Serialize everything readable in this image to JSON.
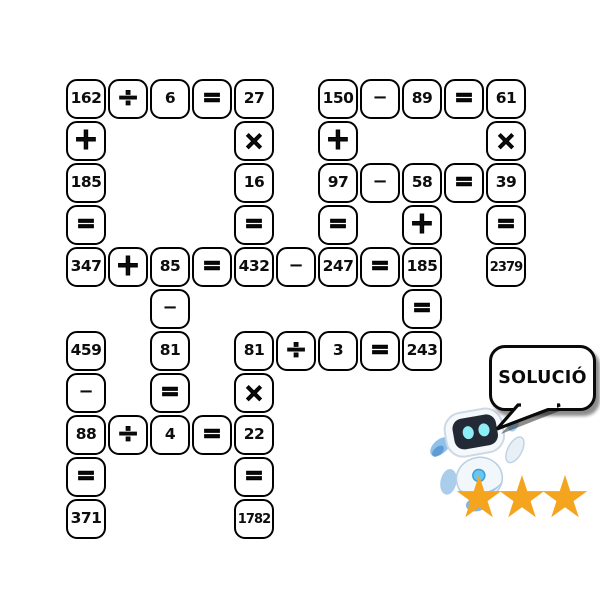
{
  "puzzle": {
    "grid": {
      "columns": 11,
      "rows": 11,
      "cell_size": 40,
      "gap": 2
    },
    "cells": [
      {
        "col": 1,
        "row": 1,
        "text": "162",
        "kind": "number"
      },
      {
        "col": 2,
        "row": 1,
        "text": "÷",
        "kind": "op-div"
      },
      {
        "col": 3,
        "row": 1,
        "text": "6",
        "kind": "number"
      },
      {
        "col": 4,
        "row": 1,
        "text": "=",
        "kind": "op-eq"
      },
      {
        "col": 5,
        "row": 1,
        "text": "27",
        "kind": "number"
      },
      {
        "col": 7,
        "row": 1,
        "text": "150",
        "kind": "number"
      },
      {
        "col": 8,
        "row": 1,
        "text": "−",
        "kind": "op-minus"
      },
      {
        "col": 9,
        "row": 1,
        "text": "89",
        "kind": "number"
      },
      {
        "col": 10,
        "row": 1,
        "text": "=",
        "kind": "op-eq"
      },
      {
        "col": 11,
        "row": 1,
        "text": "61",
        "kind": "number"
      },
      {
        "col": 1,
        "row": 2,
        "text": "+",
        "kind": "op-plus"
      },
      {
        "col": 5,
        "row": 2,
        "text": "×",
        "kind": "op-times"
      },
      {
        "col": 7,
        "row": 2,
        "text": "+",
        "kind": "op-plus"
      },
      {
        "col": 11,
        "row": 2,
        "text": "×",
        "kind": "op-times"
      },
      {
        "col": 1,
        "row": 3,
        "text": "185",
        "kind": "number"
      },
      {
        "col": 5,
        "row": 3,
        "text": "16",
        "kind": "number"
      },
      {
        "col": 7,
        "row": 3,
        "text": "97",
        "kind": "number"
      },
      {
        "col": 8,
        "row": 3,
        "text": "−",
        "kind": "op-minus"
      },
      {
        "col": 9,
        "row": 3,
        "text": "58",
        "kind": "number"
      },
      {
        "col": 10,
        "row": 3,
        "text": "=",
        "kind": "op-eq"
      },
      {
        "col": 11,
        "row": 3,
        "text": "39",
        "kind": "number"
      },
      {
        "col": 1,
        "row": 4,
        "text": "=",
        "kind": "op-eq"
      },
      {
        "col": 5,
        "row": 4,
        "text": "=",
        "kind": "op-eq"
      },
      {
        "col": 7,
        "row": 4,
        "text": "=",
        "kind": "op-eq"
      },
      {
        "col": 9,
        "row": 4,
        "text": "+",
        "kind": "op-plus"
      },
      {
        "col": 11,
        "row": 4,
        "text": "=",
        "kind": "op-eq"
      },
      {
        "col": 1,
        "row": 5,
        "text": "347",
        "kind": "number"
      },
      {
        "col": 2,
        "row": 5,
        "text": "+",
        "kind": "op-plus"
      },
      {
        "col": 3,
        "row": 5,
        "text": "85",
        "kind": "number"
      },
      {
        "col": 4,
        "row": 5,
        "text": "=",
        "kind": "op-eq"
      },
      {
        "col": 5,
        "row": 5,
        "text": "432",
        "kind": "number"
      },
      {
        "col": 6,
        "row": 5,
        "text": "−",
        "kind": "op-minus"
      },
      {
        "col": 7,
        "row": 5,
        "text": "247",
        "kind": "number"
      },
      {
        "col": 8,
        "row": 5,
        "text": "=",
        "kind": "op-eq"
      },
      {
        "col": 9,
        "row": 5,
        "text": "185",
        "kind": "number"
      },
      {
        "col": 11,
        "row": 5,
        "text": "2379",
        "kind": "number"
      },
      {
        "col": 3,
        "row": 6,
        "text": "−",
        "kind": "op-minus"
      },
      {
        "col": 9,
        "row": 6,
        "text": "=",
        "kind": "op-eq"
      },
      {
        "col": 1,
        "row": 7,
        "text": "459",
        "kind": "number"
      },
      {
        "col": 3,
        "row": 7,
        "text": "81",
        "kind": "number"
      },
      {
        "col": 5,
        "row": 7,
        "text": "81",
        "kind": "number"
      },
      {
        "col": 6,
        "row": 7,
        "text": "÷",
        "kind": "op-div"
      },
      {
        "col": 7,
        "row": 7,
        "text": "3",
        "kind": "number"
      },
      {
        "col": 8,
        "row": 7,
        "text": "=",
        "kind": "op-eq"
      },
      {
        "col": 9,
        "row": 7,
        "text": "243",
        "kind": "number"
      },
      {
        "col": 1,
        "row": 8,
        "text": "−",
        "kind": "op-minus"
      },
      {
        "col": 3,
        "row": 8,
        "text": "=",
        "kind": "op-eq"
      },
      {
        "col": 5,
        "row": 8,
        "text": "×",
        "kind": "op-times"
      },
      {
        "col": 1,
        "row": 9,
        "text": "88",
        "kind": "number"
      },
      {
        "col": 2,
        "row": 9,
        "text": "÷",
        "kind": "op-div"
      },
      {
        "col": 3,
        "row": 9,
        "text": "4",
        "kind": "number"
      },
      {
        "col": 4,
        "row": 9,
        "text": "=",
        "kind": "op-eq"
      },
      {
        "col": 5,
        "row": 9,
        "text": "22",
        "kind": "number"
      },
      {
        "col": 1,
        "row": 10,
        "text": "=",
        "kind": "op-eq"
      },
      {
        "col": 5,
        "row": 10,
        "text": "=",
        "kind": "op-eq"
      },
      {
        "col": 1,
        "row": 11,
        "text": "371",
        "kind": "number"
      },
      {
        "col": 5,
        "row": 11,
        "text": "1782",
        "kind": "number"
      }
    ]
  },
  "speech_bubble": {
    "label": "SOLUCIÓ"
  },
  "rating": {
    "count": 3,
    "symbol": "★★★",
    "color": "#F5A51D"
  },
  "colors": {
    "cell_border": "#000000",
    "cell_background": "#ffffff",
    "text": "#0d0d0d",
    "star": "#F5A51D",
    "robot_body": "#f2f7fb",
    "robot_accent": "#9cc3e8",
    "robot_screen": "#232a36",
    "robot_eyes": "#8deef8"
  }
}
